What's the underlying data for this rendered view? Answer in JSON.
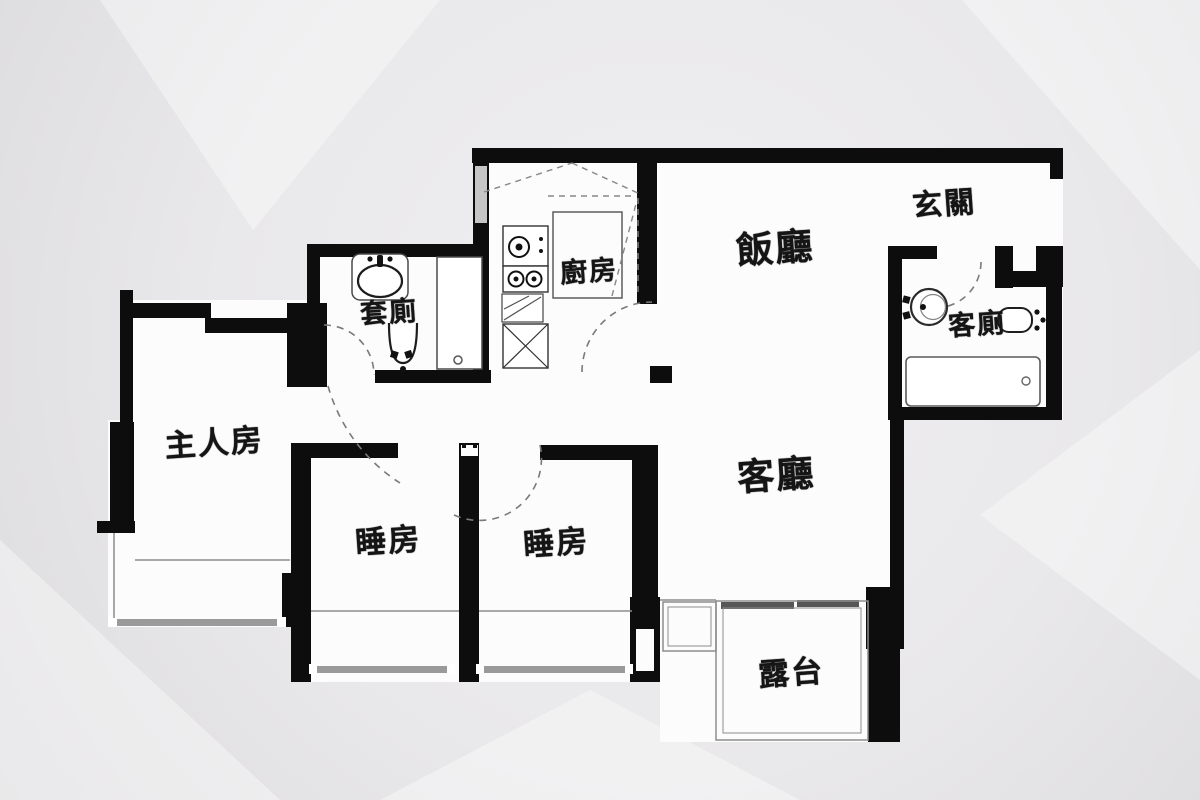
{
  "rooms": [
    {
      "id": "dining-room",
      "label": "飯廳"
    },
    {
      "id": "foyer",
      "label": "玄關"
    },
    {
      "id": "kitchen",
      "label": "廚房"
    },
    {
      "id": "ensuite-bathroom",
      "label": "套廁"
    },
    {
      "id": "guest-bathroom",
      "label": "客廁"
    },
    {
      "id": "master-bedroom",
      "label": "主人房"
    },
    {
      "id": "bedroom-1",
      "label": "睡房"
    },
    {
      "id": "bedroom-2",
      "label": "睡房"
    },
    {
      "id": "living-room",
      "label": "客廳"
    },
    {
      "id": "balcony",
      "label": "露台"
    }
  ],
  "colors": {
    "background": "#e9e8ea",
    "floor": "#fcfcfc",
    "wall": "#0d0d0d",
    "window": "#9a9a9a",
    "thin_line": "#8d8d8d",
    "door_arc": "#7a7a7a",
    "text": "#151515"
  },
  "fixtures": [
    "wash-basin",
    "toilet",
    "shower-stall",
    "bathtub",
    "cooktop-burners",
    "kitchen-cabinet",
    "sliding-balcony-door",
    "bay-window",
    "door-swing-arc"
  ]
}
